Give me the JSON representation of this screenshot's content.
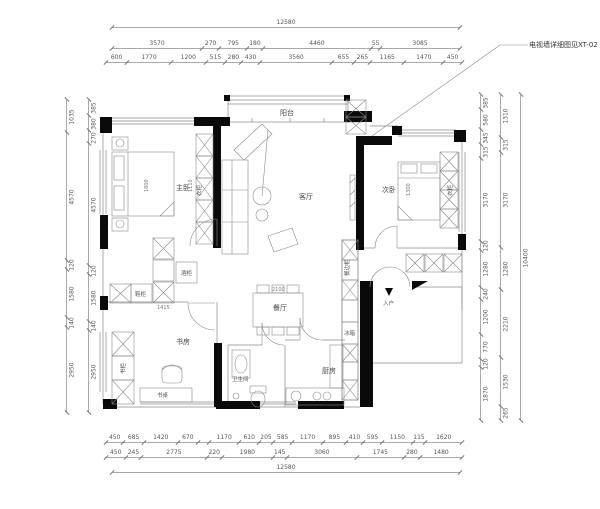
{
  "annotation": {
    "tv_wall_note": "电视墙详细图见XT-02"
  },
  "rooms": {
    "balcony": "阳台",
    "living": "客厅",
    "master_bedroom": "主卧",
    "second_bedroom": "次卧",
    "study": "书房",
    "dining": "餐厅",
    "bathroom": "卫生间",
    "kitchen": "厨房",
    "entry": "入户"
  },
  "furniture_labels": {
    "wardrobe_master": "衣柜",
    "wardrobe_second": "衣柜",
    "bookcase": "书柜",
    "desk": "书桌",
    "wine_cabinet": "酒柜",
    "shoe_cabinet": "鞋柜",
    "fridge": "冰箱",
    "sideboard": "餐边柜"
  },
  "interior_dims": {
    "bed_master": "1800",
    "wardrobe_run": "1110",
    "bed_second": "1300",
    "dining_width": "2100",
    "cabinet_run": "1415"
  },
  "dimensions": {
    "top": {
      "row_overall": [
        12580
      ],
      "row_mid": [
        3570,
        270,
        795,
        180,
        4460,
        55,
        3085
      ],
      "row_fine": [
        600,
        1770,
        1200,
        515,
        280,
        430,
        3560,
        655,
        265,
        1165,
        1470,
        450
      ]
    },
    "bottom": {
      "row_fine": [
        450,
        685,
        1420,
        670,
        {
          "v": 830,
          "label": ""
        },
        1170,
        610,
        205,
        585,
        1170,
        895,
        410,
        595,
        1150,
        115,
        1620
      ],
      "row_mid": [
        450,
        245,
        2775,
        220,
        1980,
        145,
        3060,
        1745,
        280,
        1480
      ],
      "row_overall": [
        12580
      ]
    },
    "left": {
      "outer": [
        1035,
        4570,
        120,
        1580,
        140,
        2950
      ],
      "inner": [
        385,
        380,
        270,
        4570,
        120,
        1580,
        140,
        2950
      ]
    },
    "right": {
      "inner": [
        385,
        580,
        345,
        315,
        3170,
        120,
        1280,
        240,
        1200,
        770,
        120,
        1870
      ],
      "middle": [
        1310,
        315,
        3170,
        1280,
        2210,
        1530,
        265
      ],
      "outer": [
        10400
      ]
    }
  },
  "colors": {
    "wall": "#0a0a0a",
    "line": "#8a8a8a",
    "dim_text": "#555555"
  }
}
